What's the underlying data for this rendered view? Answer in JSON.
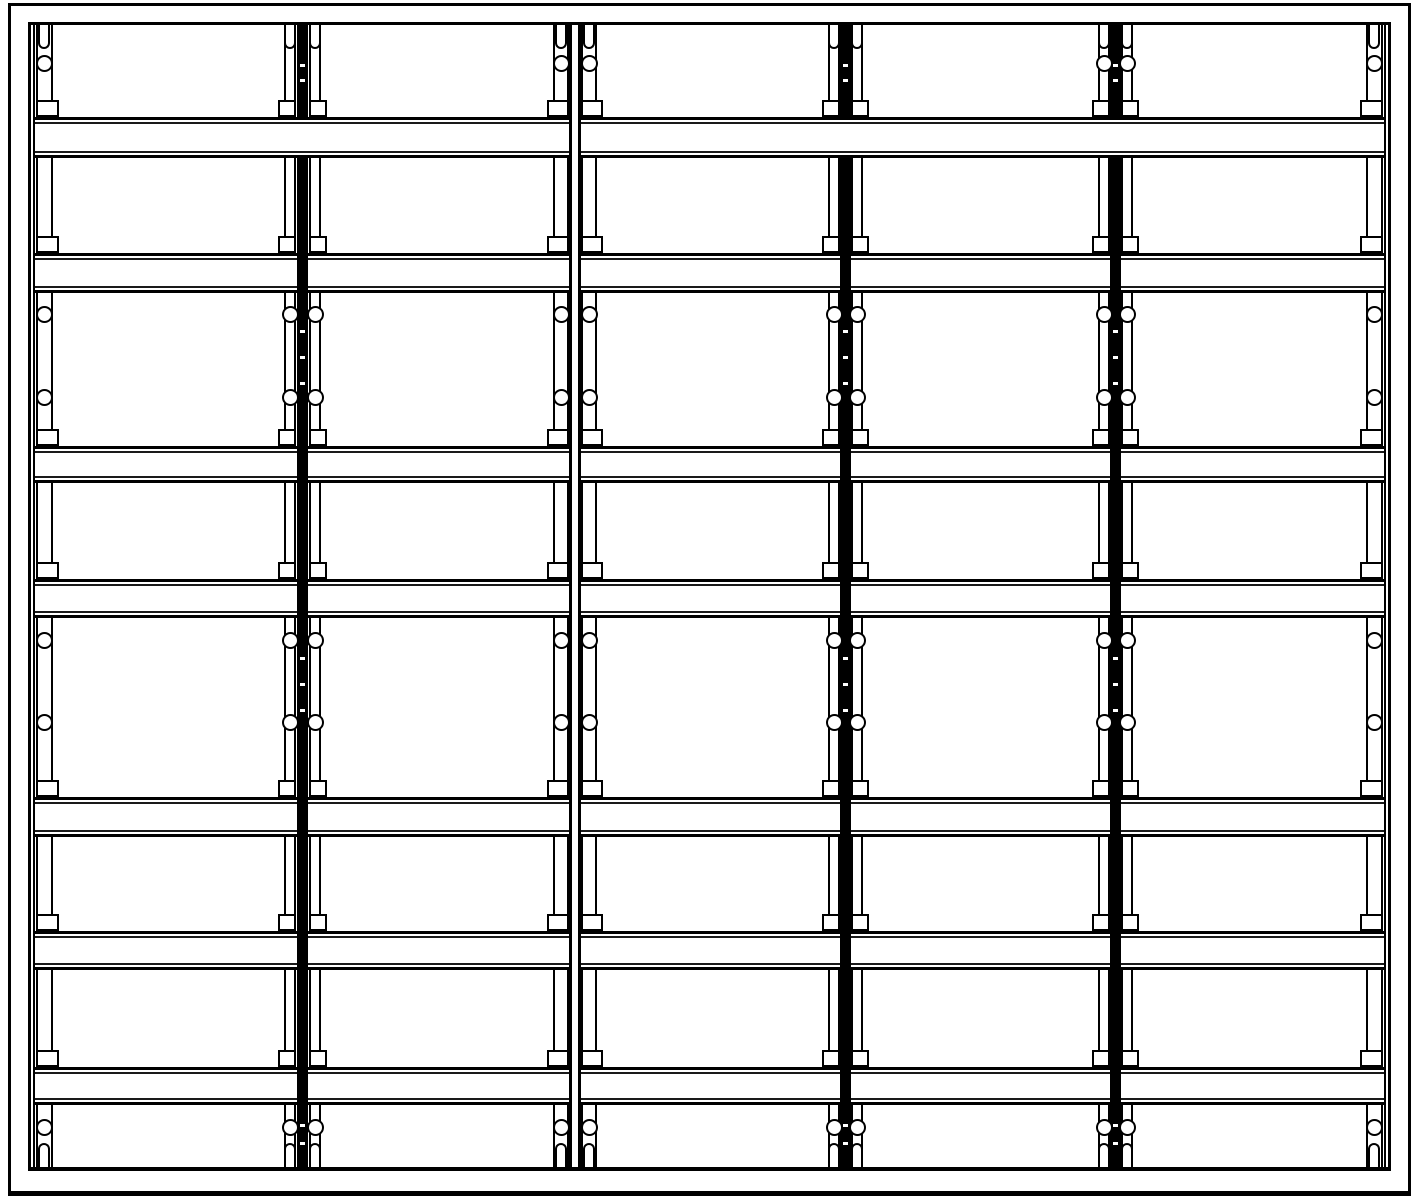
{
  "drawing": {
    "kind": "rack-shelving-front-elevation",
    "canvas": {
      "width": 1419,
      "height": 1200,
      "background": "#ffffff",
      "line_color": "#000000"
    },
    "outer_border": {
      "x": 8,
      "y": 3,
      "width": 1403,
      "height": 1193
    },
    "frame": {
      "left": 28,
      "right": 1391,
      "top_y": 22,
      "top_stroke": 3,
      "bottom_y": 1167,
      "bottom_stroke": 4
    },
    "bay_count": 5,
    "level_count": 7,
    "bay_segments": [
      [
        33,
        297
      ],
      [
        308,
        570
      ],
      [
        580,
        840
      ],
      [
        851,
        1110
      ],
      [
        1121,
        1386
      ]
    ],
    "beam_rows": [
      {
        "y": 117,
        "h": 41,
        "span": "full",
        "segments": [
          [
            33,
            570
          ],
          [
            580,
            1386
          ]
        ]
      },
      {
        "y": 253,
        "h": 40,
        "span": "bays"
      },
      {
        "y": 446,
        "h": 37,
        "span": "bays"
      },
      {
        "y": 579,
        "h": 39,
        "span": "bays"
      },
      {
        "y": 797,
        "h": 40,
        "span": "bays"
      },
      {
        "y": 931,
        "h": 39,
        "span": "bays"
      },
      {
        "y": 1067,
        "h": 38,
        "span": "bays"
      }
    ],
    "gaps": [
      [
        25,
        117
      ],
      [
        158,
        253
      ],
      [
        293,
        446
      ],
      [
        483,
        579
      ],
      [
        618,
        797
      ],
      [
        837,
        931
      ],
      [
        970,
        1067
      ],
      [
        1105,
        1167
      ]
    ],
    "verticals": {
      "spines": [
        {
          "x": 28,
          "w": 3
        },
        {
          "x": 33,
          "w": 2
        },
        {
          "x": 1384,
          "w": 2
        },
        {
          "x": 1388,
          "w": 3
        }
      ],
      "bars": [
        {
          "x": 297,
          "w": 11
        },
        {
          "x": 840,
          "w": 11
        },
        {
          "x": 1110,
          "w": 11
        }
      ],
      "bar_break_row": 0,
      "seam_lines": [
        {
          "x": 569,
          "w": 3
        },
        {
          "x": 578,
          "w": 3
        }
      ]
    },
    "posts": [
      {
        "id": "post-left-edge",
        "top_circle": true,
        "faces": [
          {
            "x": 36,
            "w": 17,
            "notch": "right",
            "cx": 44
          }
        ]
      },
      {
        "id": "bay-divider-1",
        "top_circle": false,
        "faces": [
          {
            "x": 284,
            "w": 12,
            "notch": "left",
            "cx": 290
          },
          {
            "x": 309,
            "w": 12,
            "notch": "right",
            "cx": 315
          }
        ]
      },
      {
        "id": "frame-seam",
        "top_circle": true,
        "faces": [
          {
            "x": 553,
            "w": 16,
            "notch": "left",
            "cx": 561
          },
          {
            "x": 581,
            "w": 16,
            "notch": "right",
            "cx": 589
          }
        ]
      },
      {
        "id": "bay-divider-2",
        "top_circle": false,
        "faces": [
          {
            "x": 828,
            "w": 12,
            "notch": "left",
            "cx": 834
          },
          {
            "x": 851,
            "w": 12,
            "notch": "right",
            "cx": 857
          }
        ]
      },
      {
        "id": "bay-divider-3",
        "top_circle": true,
        "faces": [
          {
            "x": 1098,
            "w": 12,
            "notch": "left",
            "cx": 1104
          },
          {
            "x": 1121,
            "w": 12,
            "notch": "right",
            "cx": 1127
          }
        ]
      },
      {
        "id": "post-right-edge",
        "top_circle": true,
        "faces": [
          {
            "x": 1366,
            "w": 17,
            "notch": "left",
            "cx": 1374
          }
        ]
      }
    ],
    "circle_rows": {
      "top": 63,
      "mid": [
        314,
        397,
        640,
        722
      ],
      "bottom": 1127
    },
    "circle": {
      "d": 17
    },
    "slot": {
      "w": 12,
      "h": 24,
      "top_y": 25,
      "bottom_y": 1143
    },
    "notch": {
      "h": 17,
      "extend": 6
    },
    "ticks": {
      "w": 5,
      "h": 3,
      "ys": [
        64,
        79,
        330,
        356,
        382,
        657,
        683,
        709,
        1124,
        1142
      ]
    }
  }
}
